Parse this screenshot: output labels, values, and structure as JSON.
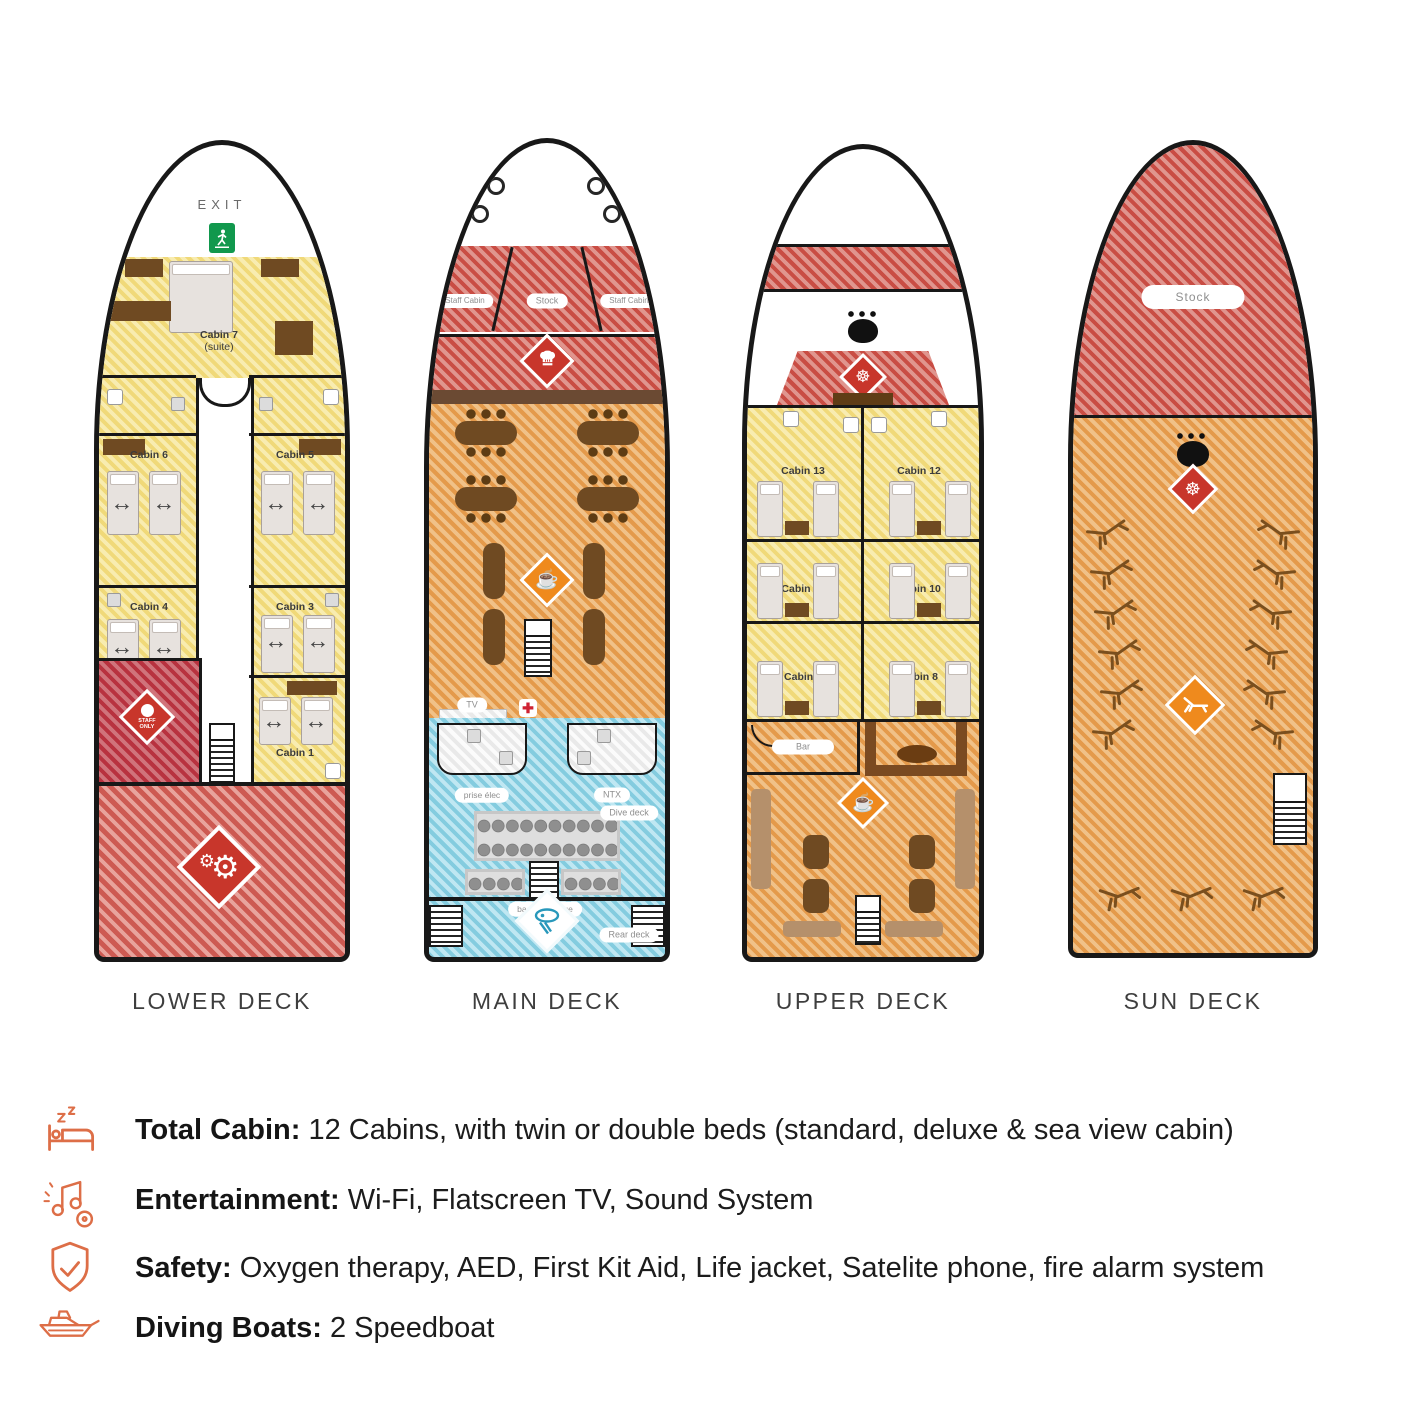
{
  "decks": {
    "lower": {
      "caption": "LOWER DECK",
      "exit_label": "EXIT",
      "cabin7": "Cabin 7",
      "cabin7_sub": "(suite)",
      "cabin6": "Cabin 6",
      "cabin5": "Cabin 5",
      "cabin4": "Cabin 4",
      "cabin3": "Cabin 3",
      "cabin1": "Cabin 1",
      "staff_only": "STAFF ONLY"
    },
    "main": {
      "caption": "MAIN DECK",
      "staff_cabin_left": "Staff Cabin",
      "stock": "Stock",
      "staff_cabin_right": "Staff Cabin",
      "tv": "TV",
      "prise_elec": "prise élec",
      "ntx": "NTX",
      "dive_deck": "Dive deck",
      "bac_de_rincage": "bac de rinçage",
      "rear_deck": "Rear deck"
    },
    "upper": {
      "caption": "UPPER DECK",
      "cabin13": "Cabin 13",
      "cabin12": "Cabin 12",
      "cabin11": "Cabin 11",
      "cabin10": "Cabin 10",
      "cabin9": "Cabin 9",
      "cabin8": "Cabin 8",
      "bar": "Bar"
    },
    "sun": {
      "caption": "SUN DECK",
      "stock": "Stock"
    }
  },
  "amenities": [
    {
      "icon": "bed-icon",
      "label": "Total Cabin:",
      "text": " 12 Cabins, with twin or double beds (standard, deluxe & sea view cabin)"
    },
    {
      "icon": "entertainment-icon",
      "label": "Entertainment:",
      "text": " Wi-Fi, Flatscreen TV, Sound System"
    },
    {
      "icon": "safety-shield-icon",
      "label": "Safety:",
      "text": " Oxygen therapy, AED, First Kit Aid, Life jacket, Satelite phone, fire alarm system"
    },
    {
      "icon": "diving-boat-icon",
      "label": "Diving Boats:",
      "text": " 2 Speedboat"
    }
  ],
  "colors": {
    "accent_orange": "#dd6e47",
    "diamond_red": "#c8362b",
    "diamond_orange": "#ef8a1d",
    "exit_green": "#11984d"
  }
}
